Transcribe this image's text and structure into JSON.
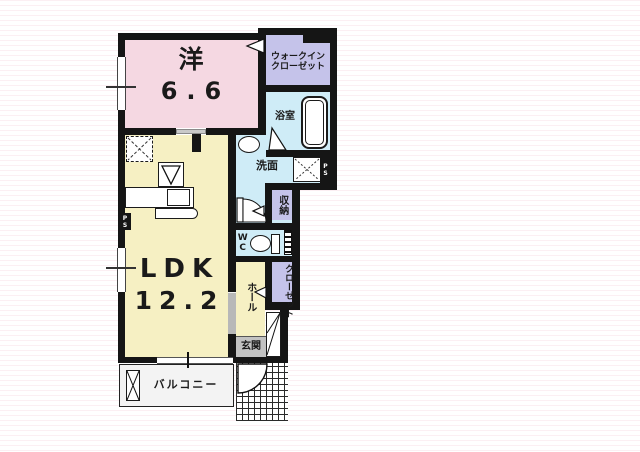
{
  "colors": {
    "wall": "#151515",
    "room_pink": "#f5d8e2",
    "room_yellow": "#f6f0c3",
    "room_blue": "#cfecf7",
    "room_lavender": "#c5c3ea",
    "entry_gray": "#c2c2c2",
    "balcony_gray": "#f3f3f3"
  },
  "rooms": {
    "western": {
      "label": "洋",
      "size": "6.6"
    },
    "walk_in_closet": {
      "label_line1": "ウォークイン",
      "label_line2": "クローゼット"
    },
    "bath": {
      "label": "浴室"
    },
    "washroom": {
      "label": "洗面"
    },
    "ldk": {
      "label": "LDK",
      "size": "12.2"
    },
    "wc": {
      "label": "WC"
    },
    "storage": {
      "label": "収納"
    },
    "hall": {
      "label": "ホール"
    },
    "closet": {
      "label": "クローゼット"
    },
    "entrance": {
      "label": "玄関"
    },
    "balcony": {
      "label": "バルコニー"
    }
  },
  "labels": {
    "pipe_space_left": "PS",
    "pipe_space_right": "PS"
  }
}
